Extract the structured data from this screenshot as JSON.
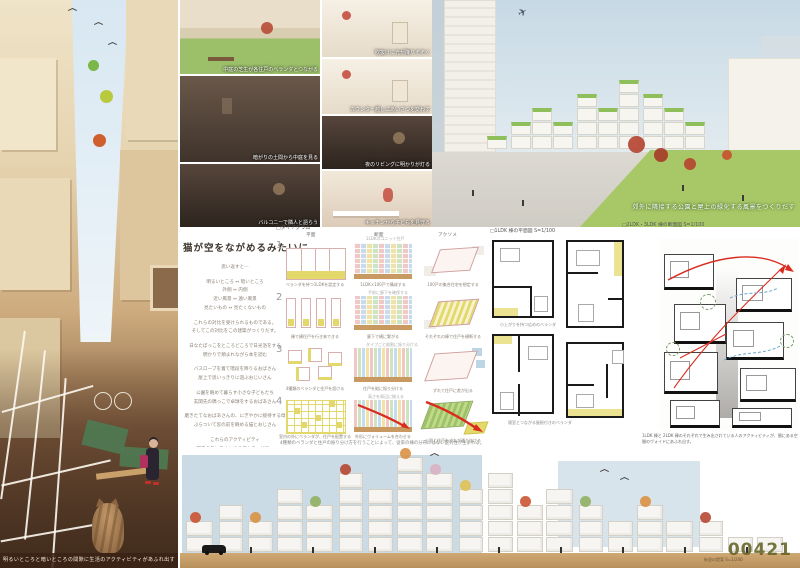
{
  "colors": {
    "accent_red": "#d92b1f",
    "highlight_yellow": "#e3d96b",
    "mosaic_pink": "#f3c6c6",
    "mosaic_green": "#cde4c0",
    "mosaic_blue": "#c6dbed",
    "mosaic_yellow": "#f2e3a4",
    "wood_base": "#c89a62",
    "roof_green": "#8fbf5a",
    "board_number_olive": "#626226"
  },
  "board": {
    "number": "00421"
  },
  "left_panel": {
    "caption": "明るいところと暗いところの間隙に生活のアクティビティがあふれ出す"
  },
  "photo_grid": {
    "tiles": [
      {
        "caption": "中庭の芝生が各住戸のベランダとつながる"
      },
      {
        "caption": "吹抜けに光が降りそそぐ"
      },
      {
        "caption": "暗がりの土間から中庭を見る"
      },
      {
        "caption": "カウンター越しにあいさつを交わす"
      },
      {
        "caption": "夜のリビングに明かりが灯る"
      },
      {
        "caption": "バルコニーで隣人と語らう"
      },
      {
        "caption": "キッチンから子どもを見守る"
      }
    ]
  },
  "hero": {
    "caption": "郊外に隣接する公園と屋上の緑化する風景をつくりだす"
  },
  "statement": {
    "title": "猫が空をながめるみたいに",
    "lines": [
      "思い返すと⋯",
      "明るいところ ↔ 暗いところ",
      "外側 ↔ 内側",
      "近い風景 ↔ 遠い風景",
      "見たいもの ↔ 見たくないもの",
      "これらの対比を受けられるものである。",
      "そしてこの対比をこの建築がつくりだす。",
      "日なたぼっこをところどころで日光浴をする",
      "明かりで頬まれながら本を読む",
      "バスローブを着て階段を降りるおばさん",
      "屋上で思いっきりに遊ぶおじいさん",
      "公園を眺めて暮らす小さな子どもたち",
      "玄関先の隅っこで卓球をするおばあさん",
      "磨きたてなおばあさんの、にぎやかに接待する母",
      "ぶらついて窓の前を眺める猫とおじさん",
      "これらのアクティビティ",
      "室内の外にあふれ出るアクティビティ",
      "この街は室内の外にシームレスに",
      "つながりをもつことで",
      "この建築が街に沿って動きを展開する。"
    ]
  },
  "diagrams": {
    "header": "□ダイアグラム",
    "columns": [
      "平面",
      "断面",
      "アクソメ"
    ],
    "rows": [
      {
        "num": "1",
        "plan": "ベランダを持つ1LDKを設定する",
        "section": "1LDK×100戸で構成する",
        "axon": "100戸の集合住宅を想定する",
        "note": "1LDKのユニット住戸"
      },
      {
        "num": "2",
        "plan": "棟で横住戸を行き来できる",
        "section": "廊下で横に繋がる",
        "axon": "それぞれの棟で住戸を横断する",
        "note": "手前に廊下を確保する"
      },
      {
        "num": "3",
        "plan": "4種類のベランダと住戸を設ける",
        "section": "住戸を縦に振り分ける",
        "axon": "ずれて住戸に差が出る",
        "note": "タイプごと縦割に振り分ける"
      },
      {
        "num": "4",
        "plan": "室内の外にベランダが、住戸を配置する",
        "section": "外形にヴォリュームを合わせる",
        "axon": "公園と住戸をずれが通り抜ける",
        "note": "高さを周辺に揃える"
      }
    ],
    "footer": "4種類のベランダと住戸の振り分け方を行うことによって、従来の棟の分布にはない配列性が生まれる。"
  },
  "plans": {
    "label": "□1LDK 棟の平面図 S=1/100",
    "notes": [
      "小上がりを持つ広めのベランダ",
      "寝室とつながる屋根付きのベランダ"
    ]
  },
  "section": {
    "label": "□2LDK・3LDK 棟の断面図 S=1/100",
    "caption": "1LDK 棟と 2LDK 棟のそれぞれで生み出されている人のアクティビティが、間にある空間のヴォイドにあふれ出す。"
  },
  "elevation": {
    "label": "街並の提案 S=1/200"
  }
}
